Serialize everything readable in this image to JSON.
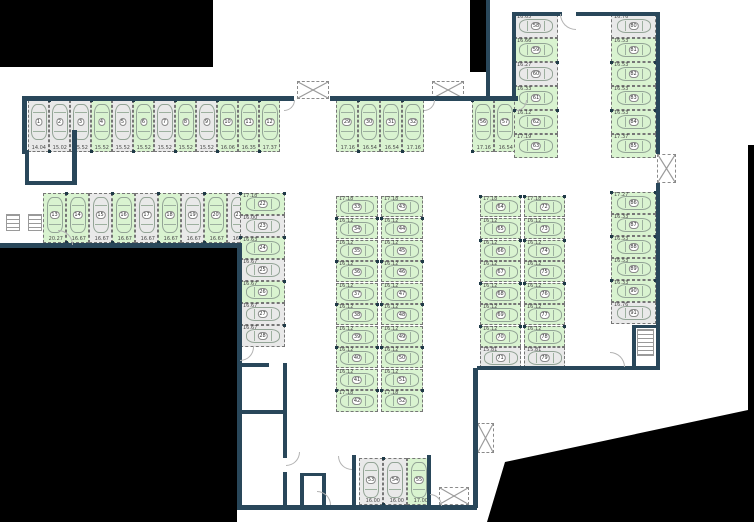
{
  "palette": {
    "outside": "#000000",
    "wall": "#29475a",
    "free_space": "#d9f3d0",
    "occupied_space": "#e9e9e9",
    "space_border": "#767676",
    "car_outline": "#93a496"
  },
  "legend": {
    "free_state": "f",
    "occupied_state": "o"
  },
  "spaces": [
    {
      "id": 1,
      "dim": "14.04",
      "st": "o",
      "d": "v",
      "x": 28,
      "y": 100,
      "w": 21,
      "h": 52
    },
    {
      "id": 2,
      "dim": "15.02",
      "st": "o",
      "d": "v",
      "x": 49,
      "y": 100,
      "w": 21,
      "h": 52
    },
    {
      "id": 3,
      "dim": "15.52",
      "st": "o",
      "d": "v",
      "x": 70,
      "y": 100,
      "w": 21,
      "h": 52
    },
    {
      "id": 4,
      "dim": "15.52",
      "st": "f",
      "d": "v",
      "x": 91,
      "y": 100,
      "w": 21,
      "h": 52
    },
    {
      "id": 5,
      "dim": "15.52",
      "st": "o",
      "d": "v",
      "x": 112,
      "y": 100,
      "w": 21,
      "h": 52
    },
    {
      "id": 6,
      "dim": "15.52",
      "st": "f",
      "d": "v",
      "x": 133,
      "y": 100,
      "w": 21,
      "h": 52
    },
    {
      "id": 7,
      "dim": "15.52",
      "st": "o",
      "d": "v",
      "x": 154,
      "y": 100,
      "w": 21,
      "h": 52
    },
    {
      "id": 8,
      "dim": "15.52",
      "st": "f",
      "d": "v",
      "x": 175,
      "y": 100,
      "w": 21,
      "h": 52
    },
    {
      "id": 9,
      "dim": "15.52",
      "st": "o",
      "d": "v",
      "x": 196,
      "y": 100,
      "w": 21,
      "h": 52
    },
    {
      "id": 10,
      "dim": "16.06",
      "st": "f",
      "d": "v",
      "x": 217,
      "y": 100,
      "w": 21,
      "h": 52
    },
    {
      "id": 11,
      "dim": "16.35",
      "st": "f",
      "d": "v",
      "x": 238,
      "y": 100,
      "w": 21,
      "h": 52
    },
    {
      "id": 12,
      "dim": "17.37",
      "st": "f",
      "d": "v",
      "x": 259,
      "y": 100,
      "w": 21,
      "h": 52
    },
    {
      "id": 13,
      "dim": "20.27",
      "st": "f",
      "d": "v",
      "x": 43,
      "y": 193,
      "w": 23,
      "h": 50
    },
    {
      "id": 14,
      "dim": "16.67",
      "st": "f",
      "d": "v",
      "x": 66,
      "y": 193,
      "w": 23,
      "h": 50
    },
    {
      "id": 15,
      "dim": "16.67",
      "st": "o",
      "d": "v",
      "x": 89,
      "y": 193,
      "w": 23,
      "h": 50
    },
    {
      "id": 16,
      "dim": "16.67",
      "st": "f",
      "d": "v",
      "x": 112,
      "y": 193,
      "w": 23,
      "h": 50
    },
    {
      "id": 17,
      "dim": "16.67",
      "st": "o",
      "d": "v",
      "x": 135,
      "y": 193,
      "w": 23,
      "h": 50
    },
    {
      "id": 18,
      "dim": "16.67",
      "st": "f",
      "d": "v",
      "x": 158,
      "y": 193,
      "w": 23,
      "h": 50
    },
    {
      "id": 19,
      "dim": "16.67",
      "st": "o",
      "d": "v",
      "x": 181,
      "y": 193,
      "w": 23,
      "h": 50
    },
    {
      "id": 20,
      "dim": "16.67",
      "st": "f",
      "d": "v",
      "x": 204,
      "y": 193,
      "w": 23,
      "h": 50
    },
    {
      "id": 21,
      "dim": "16.67",
      "st": "o",
      "d": "v",
      "x": 227,
      "y": 193,
      "w": 23,
      "h": 50
    },
    {
      "id": 22,
      "dim": "17.18",
      "st": "f",
      "d": "h",
      "x": 240,
      "y": 193,
      "w": 45,
      "h": 22
    },
    {
      "id": 23,
      "dim": "16.00",
      "st": "o",
      "d": "h",
      "x": 240,
      "y": 215,
      "w": 45,
      "h": 22
    },
    {
      "id": 24,
      "dim": "16.63",
      "st": "f",
      "d": "h",
      "x": 240,
      "y": 237,
      "w": 45,
      "h": 22
    },
    {
      "id": 25,
      "dim": "16.67",
      "st": "o",
      "d": "h",
      "x": 240,
      "y": 259,
      "w": 45,
      "h": 22
    },
    {
      "id": 26,
      "dim": "16.67",
      "st": "f",
      "d": "h",
      "x": 240,
      "y": 281,
      "w": 45,
      "h": 22
    },
    {
      "id": 27,
      "dim": "16.67",
      "st": "o",
      "d": "h",
      "x": 240,
      "y": 303,
      "w": 45,
      "h": 22
    },
    {
      "id": 28,
      "dim": "16.67",
      "st": "o",
      "d": "h",
      "x": 240,
      "y": 325,
      "w": 45,
      "h": 22
    },
    {
      "id": 29,
      "dim": "17.16",
      "st": "f",
      "d": "v",
      "x": 336,
      "y": 100,
      "w": 22,
      "h": 52
    },
    {
      "id": 30,
      "dim": "16.54",
      "st": "f",
      "d": "v",
      "x": 358,
      "y": 100,
      "w": 22,
      "h": 52
    },
    {
      "id": 31,
      "dim": "16.54",
      "st": "f",
      "d": "v",
      "x": 380,
      "y": 100,
      "w": 22,
      "h": 52
    },
    {
      "id": 32,
      "dim": "17.16",
      "st": "f",
      "d": "v",
      "x": 402,
      "y": 100,
      "w": 22,
      "h": 52
    },
    {
      "id": 33,
      "dim": "17.18",
      "st": "f",
      "d": "h",
      "x": 336,
      "y": 196,
      "w": 42,
      "h": 21
    },
    {
      "id": 34,
      "dim": "16.12",
      "st": "f",
      "d": "h",
      "x": 336,
      "y": 218,
      "w": 42,
      "h": 21
    },
    {
      "id": 35,
      "dim": "16.12",
      "st": "f",
      "d": "h",
      "x": 336,
      "y": 240,
      "w": 42,
      "h": 21
    },
    {
      "id": 36,
      "dim": "16.12",
      "st": "f",
      "d": "h",
      "x": 336,
      "y": 261,
      "w": 42,
      "h": 21
    },
    {
      "id": 37,
      "dim": "16.12",
      "st": "f",
      "d": "h",
      "x": 336,
      "y": 283,
      "w": 42,
      "h": 21
    },
    {
      "id": 38,
      "dim": "16.12",
      "st": "f",
      "d": "h",
      "x": 336,
      "y": 304,
      "w": 42,
      "h": 21
    },
    {
      "id": 39,
      "dim": "16.12",
      "st": "f",
      "d": "h",
      "x": 336,
      "y": 326,
      "w": 42,
      "h": 21
    },
    {
      "id": 40,
      "dim": "16.12",
      "st": "f",
      "d": "h",
      "x": 336,
      "y": 347,
      "w": 42,
      "h": 21
    },
    {
      "id": 41,
      "dim": "16.12",
      "st": "f",
      "d": "h",
      "x": 336,
      "y": 369,
      "w": 42,
      "h": 21
    },
    {
      "id": 42,
      "dim": "17.18",
      "st": "f",
      "d": "h",
      "x": 336,
      "y": 390,
      "w": 42,
      "h": 22
    },
    {
      "id": 43,
      "dim": "17.18",
      "st": "f",
      "d": "h",
      "x": 381,
      "y": 196,
      "w": 42,
      "h": 21
    },
    {
      "id": 44,
      "dim": "16.12",
      "st": "f",
      "d": "h",
      "x": 381,
      "y": 218,
      "w": 42,
      "h": 21
    },
    {
      "id": 45,
      "dim": "16.12",
      "st": "f",
      "d": "h",
      "x": 381,
      "y": 240,
      "w": 42,
      "h": 21
    },
    {
      "id": 46,
      "dim": "16.12",
      "st": "f",
      "d": "h",
      "x": 381,
      "y": 261,
      "w": 42,
      "h": 21
    },
    {
      "id": 47,
      "dim": "16.12",
      "st": "f",
      "d": "h",
      "x": 381,
      "y": 283,
      "w": 42,
      "h": 21
    },
    {
      "id": 48,
      "dim": "16.12",
      "st": "f",
      "d": "h",
      "x": 381,
      "y": 304,
      "w": 42,
      "h": 21
    },
    {
      "id": 49,
      "dim": "16.12",
      "st": "f",
      "d": "h",
      "x": 381,
      "y": 326,
      "w": 42,
      "h": 21
    },
    {
      "id": 50,
      "dim": "16.12",
      "st": "f",
      "d": "h",
      "x": 381,
      "y": 347,
      "w": 42,
      "h": 21
    },
    {
      "id": 51,
      "dim": "16.12",
      "st": "f",
      "d": "h",
      "x": 381,
      "y": 369,
      "w": 42,
      "h": 21
    },
    {
      "id": 52,
      "dim": "17.18",
      "st": "f",
      "d": "h",
      "x": 381,
      "y": 390,
      "w": 42,
      "h": 22
    },
    {
      "id": 53,
      "dim": "16.00",
      "st": "o",
      "d": "v",
      "x": 359,
      "y": 458,
      "w": 24,
      "h": 47
    },
    {
      "id": 54,
      "dim": "16.00",
      "st": "o",
      "d": "v",
      "x": 383,
      "y": 458,
      "w": 24,
      "h": 47
    },
    {
      "id": 55,
      "dim": "17.00",
      "st": "f",
      "d": "v",
      "x": 407,
      "y": 458,
      "w": 24,
      "h": 47
    },
    {
      "id": 56,
      "dim": "17.16",
      "st": "f",
      "d": "v",
      "x": 472,
      "y": 100,
      "w": 22,
      "h": 52
    },
    {
      "id": 57,
      "dim": "16.54",
      "st": "f",
      "d": "v",
      "x": 494,
      "y": 100,
      "w": 22,
      "h": 52
    },
    {
      "id": 58,
      "dim": "16.65",
      "st": "o",
      "d": "h",
      "x": 514,
      "y": 14,
      "w": 44,
      "h": 24
    },
    {
      "id": 59,
      "dim": "16.66",
      "st": "f",
      "d": "h",
      "x": 514,
      "y": 38,
      "w": 44,
      "h": 24
    },
    {
      "id": 60,
      "dim": "16.27",
      "st": "o",
      "d": "h",
      "x": 514,
      "y": 62,
      "w": 44,
      "h": 24
    },
    {
      "id": 61,
      "dim": "16.33",
      "st": "f",
      "d": "h",
      "x": 514,
      "y": 86,
      "w": 44,
      "h": 24
    },
    {
      "id": 62,
      "dim": "16.12",
      "st": "f",
      "d": "h",
      "x": 514,
      "y": 110,
      "w": 44,
      "h": 24
    },
    {
      "id": 63,
      "dim": "17.19",
      "st": "f",
      "d": "h",
      "x": 514,
      "y": 134,
      "w": 44,
      "h": 24
    },
    {
      "id": 64,
      "dim": "17.18",
      "st": "f",
      "d": "h",
      "x": 480,
      "y": 196,
      "w": 41,
      "h": 21
    },
    {
      "id": 65,
      "dim": "16.12",
      "st": "f",
      "d": "h",
      "x": 480,
      "y": 218,
      "w": 41,
      "h": 21
    },
    {
      "id": 66,
      "dim": "16.12",
      "st": "f",
      "d": "h",
      "x": 480,
      "y": 240,
      "w": 41,
      "h": 21
    },
    {
      "id": 67,
      "dim": "16.12",
      "st": "f",
      "d": "h",
      "x": 480,
      "y": 261,
      "w": 41,
      "h": 21
    },
    {
      "id": 68,
      "dim": "16.12",
      "st": "f",
      "d": "h",
      "x": 480,
      "y": 283,
      "w": 41,
      "h": 21
    },
    {
      "id": 69,
      "dim": "16.12",
      "st": "f",
      "d": "h",
      "x": 480,
      "y": 304,
      "w": 41,
      "h": 21
    },
    {
      "id": 70,
      "dim": "16.12",
      "st": "f",
      "d": "h",
      "x": 480,
      "y": 326,
      "w": 41,
      "h": 21
    },
    {
      "id": 71,
      "dim": "15.81",
      "st": "o",
      "d": "h",
      "x": 480,
      "y": 347,
      "w": 41,
      "h": 21
    },
    {
      "id": 72,
      "dim": "17.18",
      "st": "f",
      "d": "h",
      "x": 524,
      "y": 196,
      "w": 41,
      "h": 21
    },
    {
      "id": 73,
      "dim": "16.12",
      "st": "f",
      "d": "h",
      "x": 524,
      "y": 218,
      "w": 41,
      "h": 21
    },
    {
      "id": 74,
      "dim": "16.12",
      "st": "f",
      "d": "h",
      "x": 524,
      "y": 240,
      "w": 41,
      "h": 21
    },
    {
      "id": 75,
      "dim": "16.12",
      "st": "f",
      "d": "h",
      "x": 524,
      "y": 261,
      "w": 41,
      "h": 21
    },
    {
      "id": 76,
      "dim": "16.12",
      "st": "f",
      "d": "h",
      "x": 524,
      "y": 283,
      "w": 41,
      "h": 21
    },
    {
      "id": 77,
      "dim": "16.12",
      "st": "f",
      "d": "h",
      "x": 524,
      "y": 304,
      "w": 41,
      "h": 21
    },
    {
      "id": 78,
      "dim": "16.12",
      "st": "f",
      "d": "h",
      "x": 524,
      "y": 326,
      "w": 41,
      "h": 21
    },
    {
      "id": 79,
      "dim": "15.81",
      "st": "o",
      "d": "h",
      "x": 524,
      "y": 347,
      "w": 41,
      "h": 21
    },
    {
      "id": 80,
      "dim": "16.76",
      "st": "o",
      "d": "h",
      "x": 611,
      "y": 14,
      "w": 45,
      "h": 24
    },
    {
      "id": 81,
      "dim": "16.53",
      "st": "f",
      "d": "h",
      "x": 611,
      "y": 38,
      "w": 45,
      "h": 24
    },
    {
      "id": 82,
      "dim": "16.53",
      "st": "f",
      "d": "h",
      "x": 611,
      "y": 62,
      "w": 45,
      "h": 24
    },
    {
      "id": 83,
      "dim": "16.53",
      "st": "f",
      "d": "h",
      "x": 611,
      "y": 86,
      "w": 45,
      "h": 24
    },
    {
      "id": 84,
      "dim": "16.53",
      "st": "f",
      "d": "h",
      "x": 611,
      "y": 110,
      "w": 45,
      "h": 24
    },
    {
      "id": 85,
      "dim": "17.37",
      "st": "f",
      "d": "h",
      "x": 611,
      "y": 134,
      "w": 45,
      "h": 24
    },
    {
      "id": 86,
      "dim": "17.27",
      "st": "f",
      "d": "h",
      "x": 611,
      "y": 192,
      "w": 45,
      "h": 22
    },
    {
      "id": 87,
      "dim": "16.33",
      "st": "f",
      "d": "h",
      "x": 611,
      "y": 214,
      "w": 45,
      "h": 22
    },
    {
      "id": 88,
      "dim": "16.53",
      "st": "f",
      "d": "h",
      "x": 611,
      "y": 236,
      "w": 45,
      "h": 22
    },
    {
      "id": 89,
      "dim": "16.53",
      "st": "f",
      "d": "h",
      "x": 611,
      "y": 258,
      "w": 45,
      "h": 22
    },
    {
      "id": 90,
      "dim": "16.33",
      "st": "f",
      "d": "h",
      "x": 611,
      "y": 280,
      "w": 45,
      "h": 22
    },
    {
      "id": 91,
      "dim": "16.76",
      "st": "o",
      "d": "h",
      "x": 611,
      "y": 302,
      "w": 45,
      "h": 22
    }
  ],
  "outside_regions": [
    {
      "x": 0,
      "y": 0,
      "w": 213,
      "h": 67
    },
    {
      "x": 470,
      "y": 0,
      "w": 18,
      "h": 72
    },
    {
      "x": 0,
      "y": 248,
      "w": 237,
      "h": 274
    },
    {
      "x": 480,
      "y": 140,
      "w": 274,
      "h": 382,
      "poly": [
        [
          268,
          5
        ],
        [
          274,
          5
        ],
        [
          274,
          382
        ],
        [
          7,
          382
        ],
        [
          25,
          322
        ],
        [
          268,
          270
        ]
      ]
    }
  ],
  "walls": [
    {
      "x": 22,
      "y": 96,
      "w": 272,
      "h": 5
    },
    {
      "x": 22,
      "y": 96,
      "w": 5,
      "h": 58
    },
    {
      "x": 330,
      "y": 96,
      "w": 146,
      "h": 5
    },
    {
      "x": 486,
      "y": 0,
      "w": 4,
      "h": 98
    },
    {
      "x": 470,
      "y": 96,
      "w": 48,
      "h": 5
    },
    {
      "x": 512,
      "y": 12,
      "w": 50,
      "h": 4
    },
    {
      "x": 576,
      "y": 12,
      "w": 84,
      "h": 4
    },
    {
      "x": 512,
      "y": 12,
      "w": 4,
      "h": 86
    },
    {
      "x": 656,
      "y": 12,
      "w": 4,
      "h": 142
    },
    {
      "x": 656,
      "y": 183,
      "w": 4,
      "h": 186
    },
    {
      "x": 477,
      "y": 366,
      "w": 183,
      "h": 4
    },
    {
      "x": 632,
      "y": 325,
      "w": 4,
      "h": 44
    },
    {
      "x": 632,
      "y": 325,
      "w": 27,
      "h": 3
    },
    {
      "x": 72,
      "y": 130,
      "w": 5,
      "h": 55
    },
    {
      "x": 25,
      "y": 150,
      "w": 4,
      "h": 34
    },
    {
      "x": 25,
      "y": 181,
      "w": 52,
      "h": 4
    },
    {
      "x": 0,
      "y": 243,
      "w": 242,
      "h": 5
    },
    {
      "x": 237,
      "y": 243,
      "w": 5,
      "h": 267
    },
    {
      "x": 237,
      "y": 505,
      "w": 240,
      "h": 5
    },
    {
      "x": 237,
      "y": 363,
      "w": 32,
      "h": 4
    },
    {
      "x": 283,
      "y": 363,
      "w": 4,
      "h": 51
    },
    {
      "x": 237,
      "y": 410,
      "w": 50,
      "h": 4
    },
    {
      "x": 283,
      "y": 412,
      "w": 4,
      "h": 46
    },
    {
      "x": 283,
      "y": 472,
      "w": 4,
      "h": 36
    },
    {
      "x": 300,
      "y": 473,
      "w": 4,
      "h": 34
    },
    {
      "x": 322,
      "y": 473,
      "w": 4,
      "h": 34
    },
    {
      "x": 300,
      "y": 473,
      "w": 26,
      "h": 3
    },
    {
      "x": 352,
      "y": 455,
      "w": 4,
      "h": 52
    },
    {
      "x": 427,
      "y": 455,
      "w": 4,
      "h": 52
    },
    {
      "x": 473,
      "y": 368,
      "w": 5,
      "h": 140
    }
  ],
  "elevators": [
    {
      "x": 297,
      "y": 81,
      "w": 32,
      "h": 18
    },
    {
      "x": 432,
      "y": 81,
      "w": 32,
      "h": 18
    },
    {
      "x": 657,
      "y": 154,
      "w": 19,
      "h": 29
    },
    {
      "x": 477,
      "y": 423,
      "w": 17,
      "h": 30
    },
    {
      "x": 439,
      "y": 487,
      "w": 30,
      "h": 18
    }
  ],
  "stairs": [
    {
      "x": 6,
      "y": 214,
      "w": 14,
      "h": 17
    },
    {
      "x": 28,
      "y": 214,
      "w": 14,
      "h": 17
    },
    {
      "x": 637,
      "y": 329,
      "w": 17,
      "h": 27
    }
  ],
  "doors": [
    {
      "x": 284,
      "y": 100,
      "r": 11,
      "o": "se"
    },
    {
      "x": 424,
      "y": 100,
      "r": 11,
      "o": "se"
    },
    {
      "x": 516,
      "y": 100,
      "r": 11,
      "o": "se"
    },
    {
      "x": 560,
      "y": 14,
      "r": 16,
      "o": "sw"
    },
    {
      "x": 58,
      "y": 230,
      "r": 15,
      "o": "ne"
    },
    {
      "x": 240,
      "y": 347,
      "r": 14,
      "o": "se"
    },
    {
      "x": 610,
      "y": 352,
      "r": 15,
      "o": "ne"
    },
    {
      "x": 286,
      "y": 452,
      "r": 14,
      "o": "se"
    },
    {
      "x": 317,
      "y": 491,
      "r": 14,
      "o": "ne"
    },
    {
      "x": 338,
      "y": 456,
      "r": 14,
      "o": "sw"
    },
    {
      "x": 430,
      "y": 494,
      "r": 12,
      "o": "ne"
    }
  ]
}
